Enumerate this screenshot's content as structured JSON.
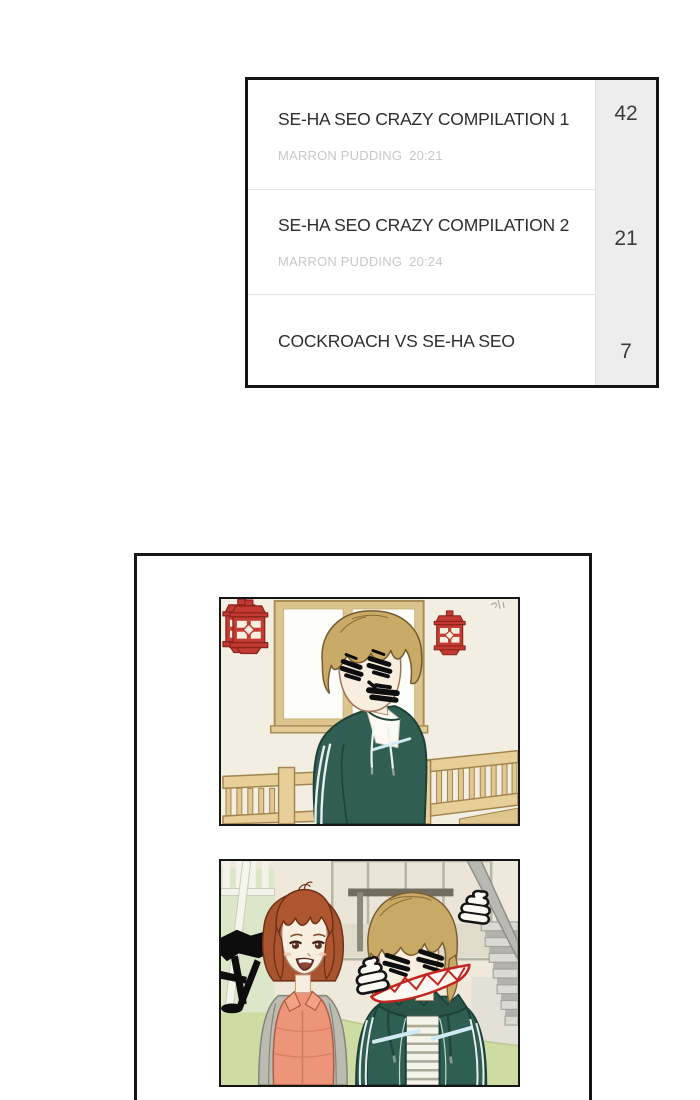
{
  "episode_list": {
    "items": [
      {
        "title": "SE-HA SEO CRAZY COMPILATION 1",
        "author": "MARRON PUDDING",
        "time": "20:21",
        "count": "42"
      },
      {
        "title": "SE-HA SEO CRAZY COMPILATION 2",
        "author": "MARRON PUDDING",
        "time": "20:24",
        "count": "21"
      },
      {
        "title": "COCKROACH VS SE-HA SEO",
        "count": "7"
      }
    ]
  },
  "comic_viewer": {
    "panels": [
      {
        "name": "boy-by-window",
        "description": "Boy in teal hoodie with scribbled-out eyes and mouth, window and two red lanterns, wooden railing"
      },
      {
        "name": "girl-and-boy",
        "description": "Smiling girl in coral puffer vest beside boy with scribbled eyes and red jagged drawn mouth, poop doodles, staircase"
      }
    ]
  },
  "colors": {
    "lantern_red": "#c23a31",
    "hoodie_teal": "#2f5e52",
    "vest_coral": "#ec9579",
    "floor_green": "#cedca3",
    "number_column_bg": "#ededed",
    "border_black": "#161616",
    "mouth_scribble_red": "#c32420"
  }
}
